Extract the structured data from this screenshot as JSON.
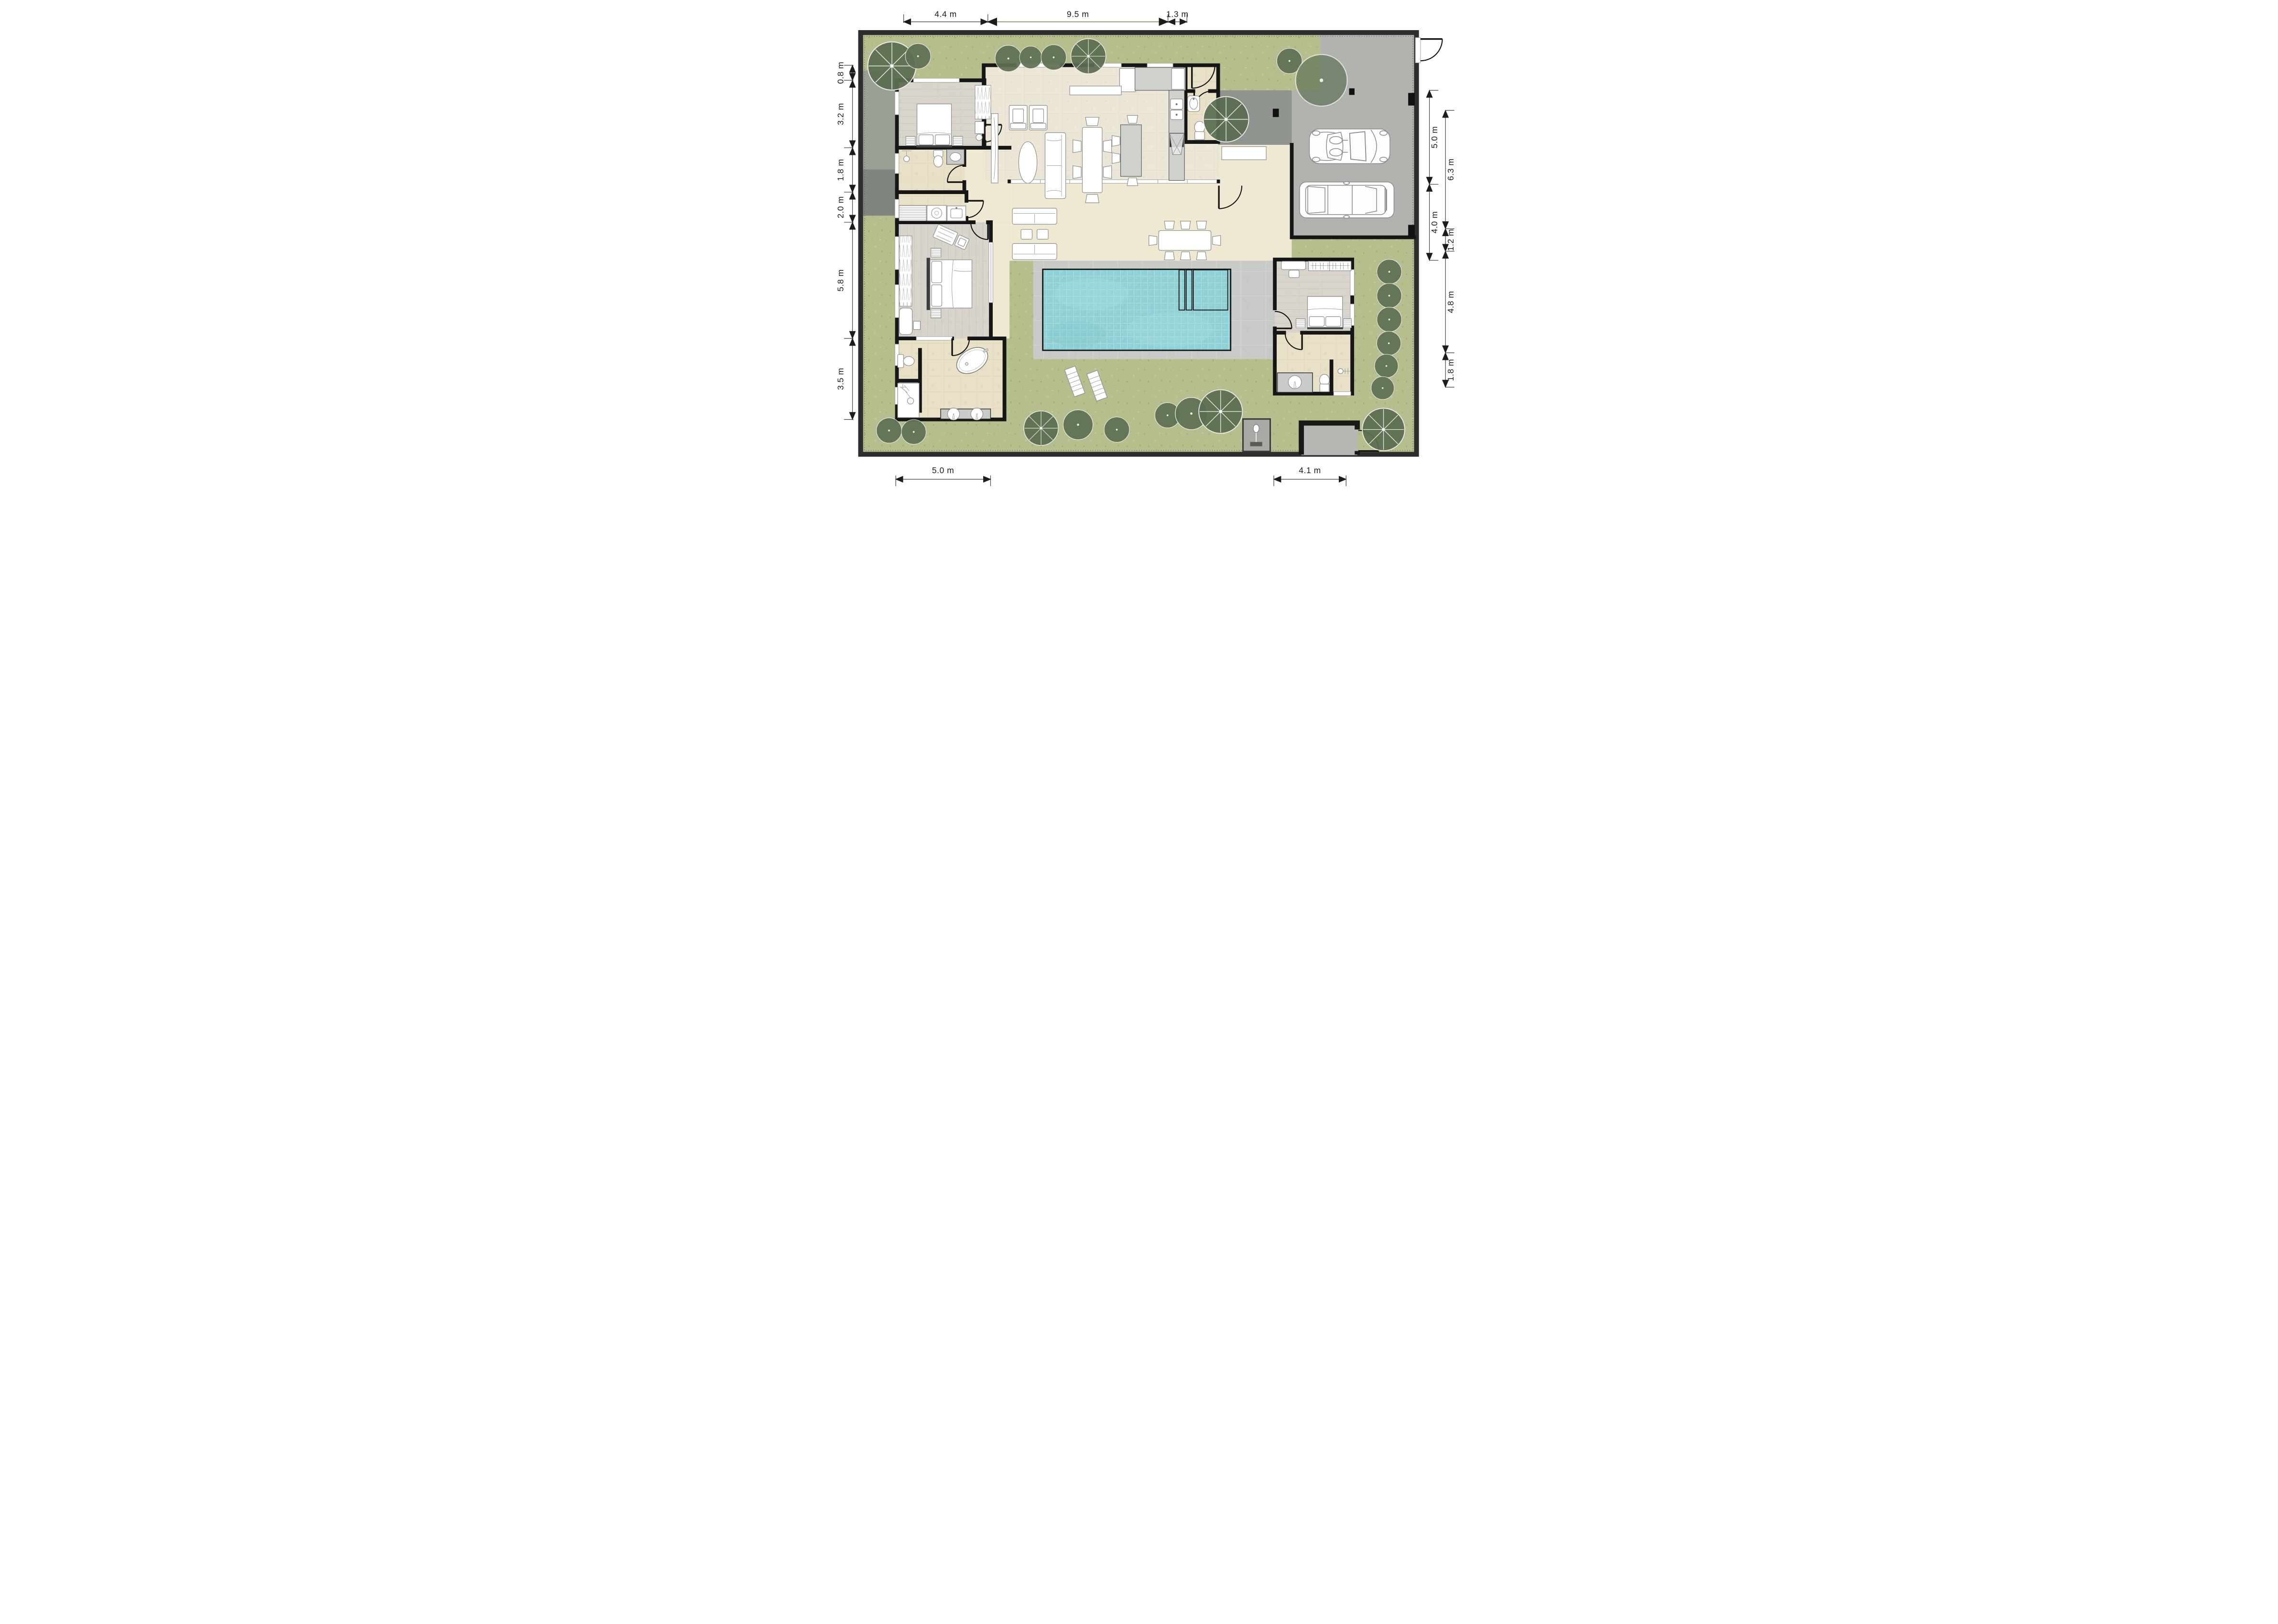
{
  "title": "Villa floor plan with pool, garden and carport (top view)",
  "dimensions": {
    "unit": "m",
    "top": [
      "4.4 m",
      "9.5 m",
      "1.3 m"
    ],
    "left": [
      "0.8 m",
      "3.2 m",
      "1.8 m",
      "2.0 m",
      "5.8 m",
      "3.5 m"
    ],
    "right": [
      "5.0 m",
      "6.3 m",
      "4.0 m",
      "1.2 m",
      "4.8 m",
      "1.8 m"
    ],
    "bottom": [
      "5.0 m",
      "4.1 m"
    ]
  },
  "colors": {
    "grass": "#b7be8e",
    "tree": "#5f7054",
    "pool_water": "#8ed0d5",
    "pool_deck": "#c7cac7",
    "patio": "#efe9d3",
    "driveway": "#b0b3ae",
    "walkway": "#90948e",
    "boundary_wall": "#2e2e2e",
    "interior_wall": "#161616",
    "wood_floor": "#d9d5cd",
    "living_tile": "#ebe6d5",
    "bath_tile": "#e8e0c7",
    "furniture": "#ffffff",
    "dimension_text": "#1c1c1c",
    "dimension_line": "#3c3c3c",
    "dimension_line_grass": "#7f8140"
  },
  "features": {
    "pool": "swimming-pool",
    "carport_cars": 2,
    "bedrooms": 3,
    "bathrooms": 4
  }
}
